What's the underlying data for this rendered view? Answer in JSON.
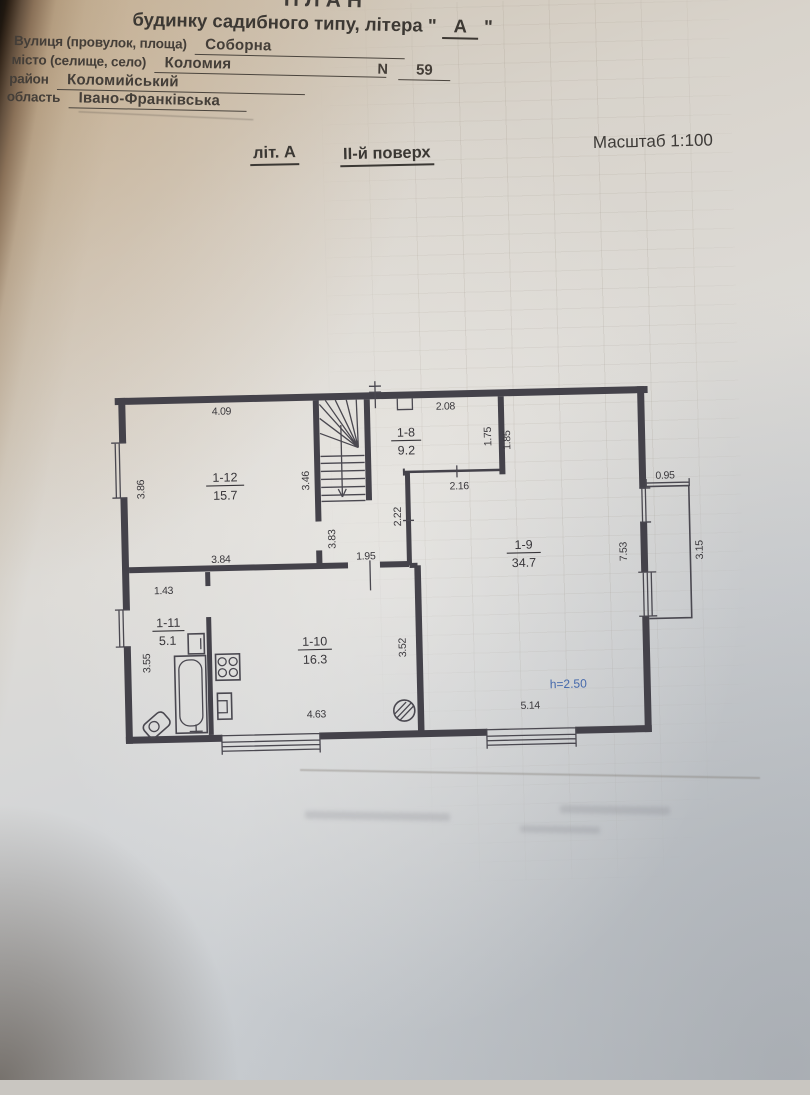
{
  "header": {
    "clipped_title": "ПЛАН",
    "building_line": "будинку садибного типу, літера \"",
    "building_letter": "А",
    "building_line_end": "\"",
    "fields": [
      {
        "label": "Вулиця (провулок, площа)",
        "value": "Соборна"
      },
      {
        "label": "місто (селище, село)",
        "value": "Коломия"
      },
      {
        "label": "район",
        "value": "Коломийський"
      },
      {
        "label": "область",
        "value": "Івано-Франківська"
      }
    ],
    "number_label": "N",
    "number_value": "59"
  },
  "subheader": {
    "liter": "літ. А",
    "floor": "ІІ-й поверх",
    "scale": "Масштаб 1:100"
  },
  "plan": {
    "rooms": [
      {
        "id": "1-12",
        "area": "15.7"
      },
      {
        "id": "1-8",
        "area": "9.2"
      },
      {
        "id": "1-9",
        "area": "34.7"
      },
      {
        "id": "1-10",
        "area": "16.3"
      },
      {
        "id": "1-11",
        "area": "5.1"
      }
    ],
    "dims": {
      "r12_top": "4.09",
      "r12_left": "3.86",
      "r12_right": "3.46",
      "r12_bottom": "3.84",
      "r8_top": "2.08",
      "r8_right": "1.75",
      "r9_upper_left": "1.85",
      "r8_bottom": "2.16",
      "hall_right": "2.22",
      "hall_left": "3.83",
      "hall_bottom": "1.95",
      "r9_right": "7.53",
      "r9_bottom": "5.14",
      "balcony_top": "0.95",
      "balcony_right": "3.15",
      "r11_top": "1.43",
      "r11_left": "3.55",
      "r10_right": "3.52",
      "r10_bottom": "4.63",
      "height_note": "h=2.50"
    },
    "colors": {
      "line": "#44424a",
      "blue": "#4468ab"
    }
  }
}
